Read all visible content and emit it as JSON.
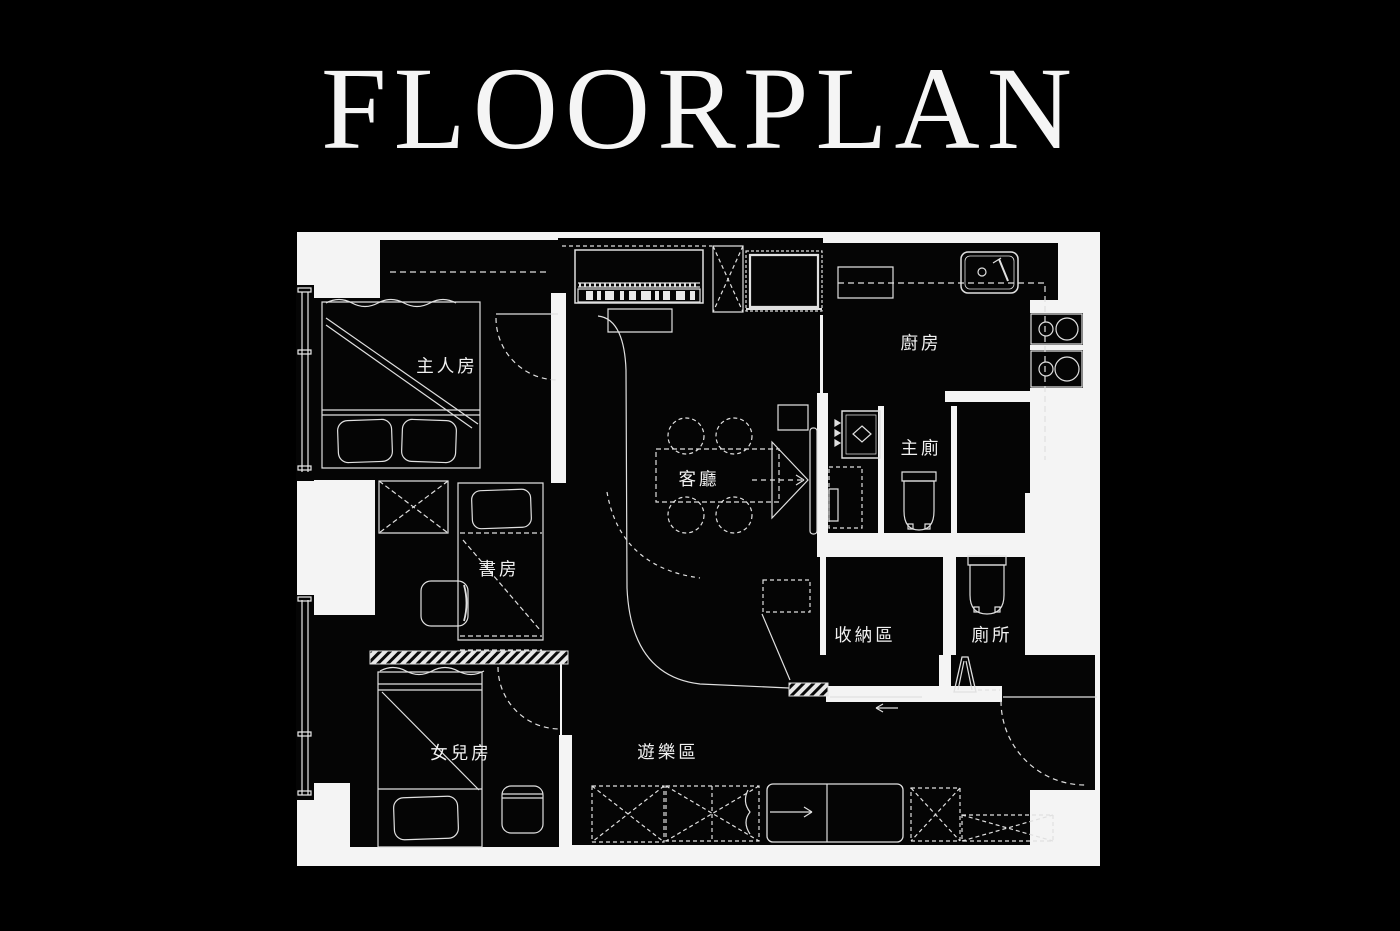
{
  "title": "FLOORPLAN",
  "colors": {
    "background": "#000000",
    "paper": "#f4f4f4",
    "room_fill": "#050505",
    "line": "#e8e8e8",
    "label_text": "#f2f2f2"
  },
  "rooms": [
    {
      "id": "master-bedroom",
      "label": "主人房"
    },
    {
      "id": "kitchen",
      "label": "廚房"
    },
    {
      "id": "master-bathroom",
      "label": "主廁"
    },
    {
      "id": "living-room",
      "label": "客廳"
    },
    {
      "id": "study",
      "label": "書房"
    },
    {
      "id": "storage-area",
      "label": "收納區"
    },
    {
      "id": "toilet",
      "label": "廁所"
    },
    {
      "id": "daughters-room",
      "label": "女兒房"
    },
    {
      "id": "play-area",
      "label": "遊樂區"
    }
  ]
}
